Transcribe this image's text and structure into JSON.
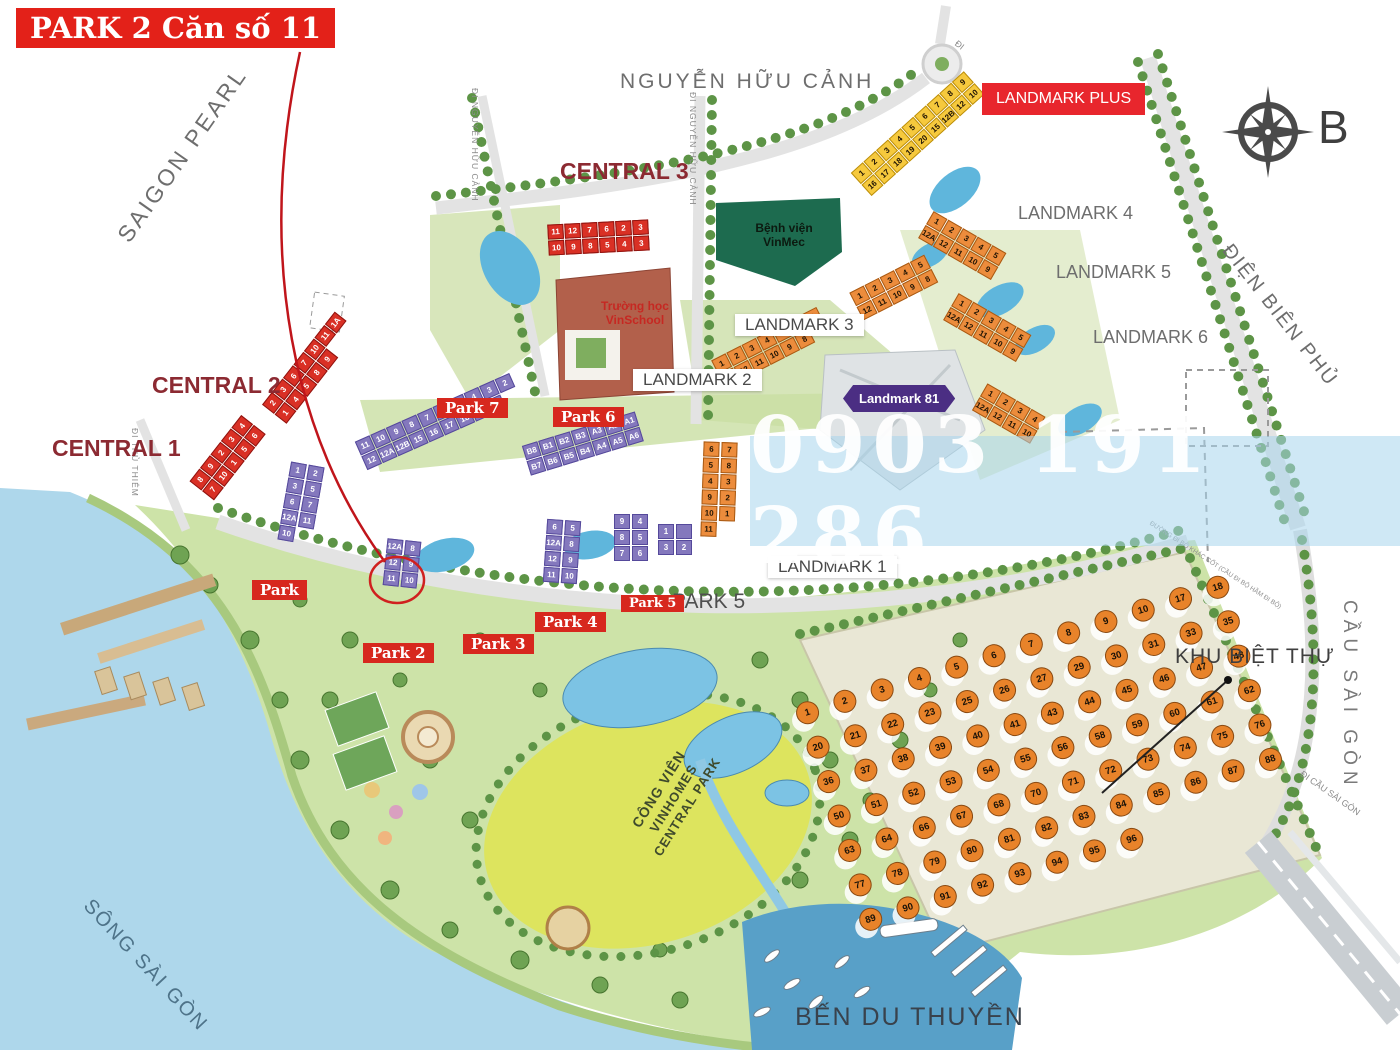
{
  "callout": {
    "label": "PARK 2 Căn số 11"
  },
  "compass": {
    "north_label": "B"
  },
  "watermark": {
    "phone": "0903 191 286"
  },
  "colors": {
    "accent_red": "#e32119",
    "badge_red": "#d7281e",
    "purple": "#8478bd",
    "landmark81_purple": "#4b2e83",
    "orange": "#ec8c3c",
    "yellow": "#f6c93d",
    "water": "#aed7eb",
    "marina": "#58a0c8",
    "park_green": "#cde3a8",
    "lawn": "#dde45e",
    "label_gray": "#6e6e6e",
    "central_maroon": "#8c2a32"
  },
  "streets": {
    "nguyen_huu_canh": "NGUYỄN HỮU CẢNH",
    "di_nguyen_huu_canh": "ĐI NGUYỄN HỮU CẢNH",
    "dien_bien_phu": "ĐIỆN BIÊN PHỦ",
    "cau_sai_gon": "CẦU SÀI GÒN",
    "di_thu_thiem": "ĐI THỦ THIÊM",
    "di_cau_sai_gon": "ĐI CẦU SÀI GÒN",
    "di_short": "ĐI",
    "pedestrian_note": "ĐƯỜNG ĐI BỘ KHÁC CỐT (CẦU ĐI BỘ HẦM ĐI BỘ)",
    "song_sai_gon": "SÔNG SÀI GÒN"
  },
  "areas": {
    "saigon_pearl": "SAIGON PEARL",
    "central_1": "CENTRAL 1",
    "central_2": "CENTRAL 2",
    "central_3": "CENTRAL 3",
    "landmark_1": "LANDMARK 1",
    "landmark_2": "LANDMARK 2",
    "landmark_3": "LANDMARK 3",
    "landmark_4": "LANDMARK 4",
    "landmark_5": "LANDMARK 5",
    "landmark_6": "LANDMARK 6",
    "landmark_plus": "LANDMARK PLUS",
    "landmark_81": "Landmark 81",
    "park_5_area": "PARK 5",
    "villa_zone": "KHU BIỆT THỰ",
    "marina": "BẾN DU THUYỀN",
    "park_name_line1": "CÔNG VIÊN",
    "park_name_line2": "VINHOMES CENTRAL PARK"
  },
  "facilities": {
    "hospital_line1": "Bệnh viện",
    "hospital_line2": "VinMec",
    "school_line1": "Trường học",
    "school_line2": "VinSchool"
  },
  "badges": {
    "park_1": "Park",
    "park_2": "Park 2",
    "park_3": "Park 3",
    "park_4": "Park 4",
    "park_5": "Park 5",
    "park_6": "Park 6",
    "park_7": "Park 7"
  },
  "buildings": {
    "central_3_row_a": [
      "11",
      "12",
      "7",
      "6",
      "2",
      "3"
    ],
    "central_3_row_b": [
      "10",
      "9",
      "8",
      "5",
      "4",
      "3"
    ],
    "central_2_row_a": [
      "2",
      "3",
      "6",
      "7",
      "10",
      "11",
      "1A"
    ],
    "central_2_row_b": [
      "1",
      "4",
      "5",
      "8",
      "9"
    ],
    "central_1_row_a": [
      "8",
      "9",
      "2",
      "3",
      "4"
    ],
    "central_1_row_b": [
      "7",
      "10",
      "1",
      "5",
      "6"
    ],
    "landmark_plus_row_a": [
      "1",
      "2",
      "3",
      "4",
      "5",
      "6",
      "7",
      "8",
      "9"
    ],
    "landmark_plus_row_b": [
      "16",
      "17",
      "18",
      "19",
      "20",
      "15",
      "12B",
      "12",
      "10"
    ],
    "landmark_2_row_a": [
      "1",
      "2",
      "3",
      "4",
      "5",
      "6",
      "7"
    ],
    "landmark_2_row_b": [
      "12A",
      "12",
      "11",
      "10",
      "9",
      "8"
    ],
    "landmark_3_row_a": [
      "1",
      "2",
      "3",
      "4",
      "5"
    ],
    "landmark_3_row_b": [
      "12",
      "11",
      "10",
      "9",
      "8"
    ],
    "landmark_4_row_a": [
      "1",
      "2",
      "3",
      "4",
      "5"
    ],
    "landmark_4_row_b": [
      "12A",
      "12",
      "11",
      "10",
      "9"
    ],
    "landmark_5_row_a": [
      "1",
      "2",
      "3",
      "4",
      "5"
    ],
    "landmark_5_row_b": [
      "12A",
      "12",
      "11",
      "10",
      "9"
    ],
    "landmark_6_row_a": [
      "1",
      "2",
      "3",
      "4"
    ],
    "landmark_6_row_b": [
      "12A",
      "12",
      "11",
      "10"
    ],
    "landmark_1_units": [
      "6",
      "7",
      "5",
      "8",
      "4",
      "3",
      "9",
      "2",
      "10",
      "1",
      "11"
    ],
    "park_7_row_a": [
      "11",
      "10",
      "9",
      "8",
      "7",
      "6",
      "5",
      "4",
      "3",
      "2"
    ],
    "park_7_row_b": [
      "12",
      "12A",
      "12B",
      "15",
      "16",
      "17",
      "18",
      "19",
      "1"
    ],
    "park_6_row_a": [
      "B8",
      "B1",
      "B2",
      "B3",
      "A3",
      "A2",
      "A1"
    ],
    "park_6_row_b": [
      "B7",
      "B6",
      "B5",
      "B4",
      "A4",
      "A5",
      "A6"
    ],
    "park_1_units": [
      "1",
      "2",
      "3",
      "5",
      "6",
      "7",
      "12A",
      "11",
      "10"
    ],
    "park_2_units": [
      "12A",
      "8",
      "12",
      "9",
      "11",
      "10"
    ],
    "park_3_units": [
      "6",
      "5",
      "12A",
      "8",
      "12",
      "9",
      "11",
      "10"
    ],
    "park_4_units": [
      "9",
      "4",
      "8",
      "5",
      "7",
      "6"
    ],
    "park_5_units": [
      "1",
      " ",
      "3",
      "2"
    ]
  },
  "villas": {
    "numbers": [
      "1",
      "2",
      "3",
      "4",
      "5",
      "6",
      "7",
      "8",
      "9",
      "10",
      "17",
      "18",
      "20",
      "21",
      "22",
      "23",
      "25",
      "26",
      "27",
      "29",
      "30",
      "31",
      "33",
      "35",
      "36",
      "37",
      "38",
      "39",
      "40",
      "41",
      "43",
      "44",
      "45",
      "46",
      "47",
      "48",
      "50",
      "51",
      "52",
      "53",
      "54",
      "55",
      "56",
      "58",
      "59",
      "60",
      "61",
      "62",
      "63",
      "64",
      "66",
      "67",
      "68",
      "70",
      "71",
      "72",
      "73",
      "74",
      "75",
      "76",
      "77",
      "78",
      "79",
      "80",
      "81",
      "82",
      "83",
      "84",
      "85",
      "86",
      "87",
      "88",
      "89",
      "90",
      "91",
      "92",
      "93",
      "94",
      "95",
      "96"
    ]
  }
}
